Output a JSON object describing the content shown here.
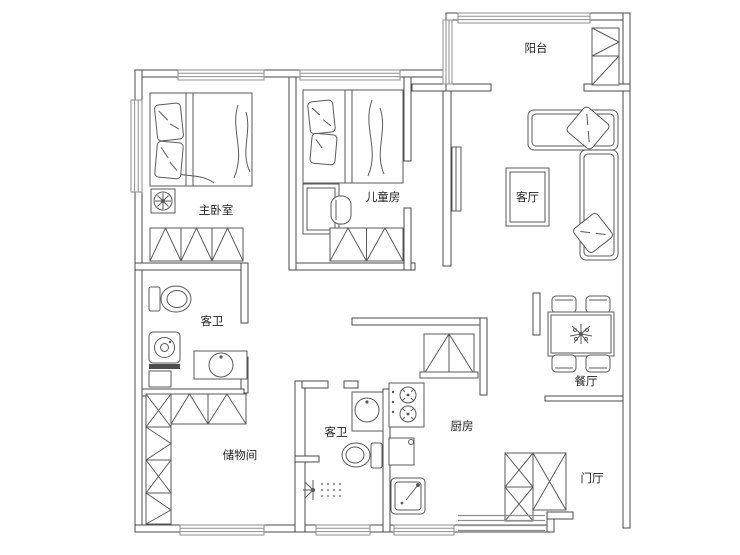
{
  "rooms": {
    "master": {
      "label": "主卧室"
    },
    "kids": {
      "label": "儿童房"
    },
    "balcony": {
      "label": "阳台"
    },
    "living": {
      "label": "客厅"
    },
    "bath1": {
      "label": "客卫"
    },
    "storage": {
      "label": "储物间"
    },
    "bath2": {
      "label": "客卫"
    },
    "kitchen": {
      "label": "厨房"
    },
    "dining": {
      "label": "餐厅"
    },
    "foyer": {
      "label": "门厅"
    }
  },
  "furniture": {
    "master_bedroom": [
      "double-bed",
      "pillows",
      "wardrobe",
      "ceiling-fan"
    ],
    "kids_room": [
      "bed",
      "pillows",
      "desk-with-chair",
      "wardrobe"
    ],
    "balcony": [
      "storage-cabinet"
    ],
    "living_room": [
      "l-shaped-sofa",
      "throw-pillows",
      "rug",
      "wall-tv"
    ],
    "dining_room": [
      "table-with-4-chairs",
      "plant-centerpiece"
    ],
    "bath_upper": [
      "toilet",
      "washing-machine",
      "vanity-basin"
    ],
    "bath_lower": [
      "vanity-basin",
      "toilet",
      "shower-spray",
      "floor-drain-dots"
    ],
    "kitchen": [
      "cabinet-fridge",
      "gas-stove-2-burner",
      "base-cabinet",
      "sink"
    ],
    "storage_room": [
      "shelving-cabinets"
    ],
    "foyer": [
      "shoe-cabinets",
      "entry-steps"
    ]
  },
  "colors": {
    "wall": "#4a4a4a",
    "furniture_line": "#5a5a5a",
    "window_line": "#8e8e8e",
    "text": "#1f1f1f",
    "background": "#ffffff"
  }
}
